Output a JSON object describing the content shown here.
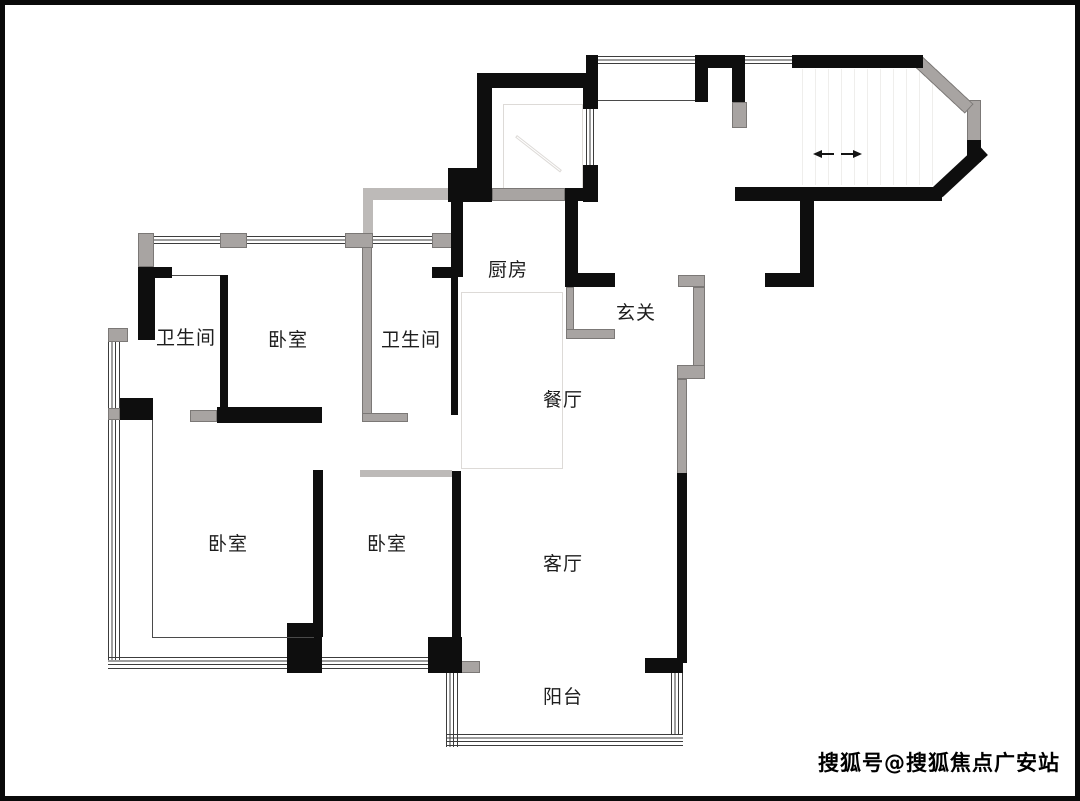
{
  "rooms": [
    {
      "id": "kitchen",
      "label": "厨房"
    },
    {
      "id": "foyer",
      "label": "玄关"
    },
    {
      "id": "bathroom-1",
      "label": "卫生间"
    },
    {
      "id": "bedroom-1",
      "label": "卧室"
    },
    {
      "id": "bathroom-2",
      "label": "卫生间"
    },
    {
      "id": "dining",
      "label": "餐厅"
    },
    {
      "id": "living",
      "label": "客厅"
    },
    {
      "id": "bedroom-2",
      "label": "卧室"
    },
    {
      "id": "bedroom-3",
      "label": "卧室"
    },
    {
      "id": "balcony",
      "label": "阳台"
    }
  ],
  "watermark": {
    "text": "搜狐号@搜狐焦点广安站"
  },
  "colors": {
    "wall_black": "#0e0e0e",
    "wall_gray": "#a8a4a2",
    "wall_light": "#bdbab8",
    "window_line": "#3c3c3c",
    "background": "#ffffff",
    "frame": "#0a0a0a"
  }
}
